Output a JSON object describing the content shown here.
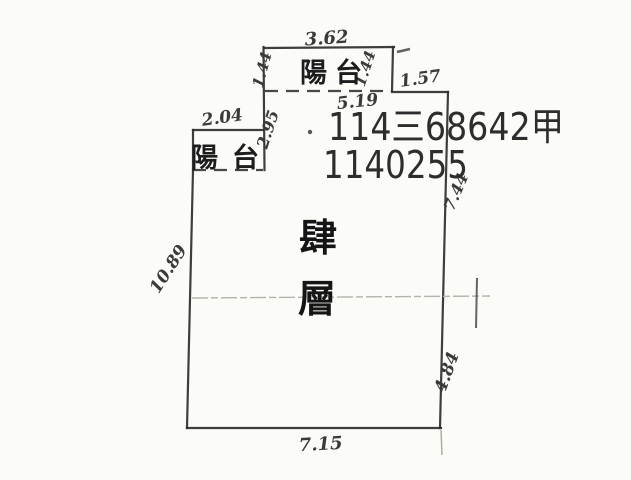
{
  "colors": {
    "paper": "#fbfbf8",
    "ink": "#2e2e2e",
    "stamp_ink": "#2d2d2d",
    "faint_line": "#b3b3ad"
  },
  "stamp": {
    "line1": "114三68642甲",
    "line2": "1140255"
  },
  "floor_label": {
    "char1": "肆",
    "char2": "層"
  },
  "rooms": {
    "balcony_top_label": "陽台",
    "balcony_left_label": "陽台"
  },
  "dimensions": {
    "balcony_top_width": "3.62",
    "balcony_top_left_depth": "1.44",
    "balcony_top_right_depth": "1.44",
    "top_right_segment": "1.57",
    "top_interior_width": "5.19",
    "balcony_left_width": "2.04",
    "upper_left_wall": "2.95",
    "left_wall": "10.89",
    "right_wall_upper": "7.44",
    "right_wall_lower": "4.84",
    "bottom_wall": "7.15"
  }
}
